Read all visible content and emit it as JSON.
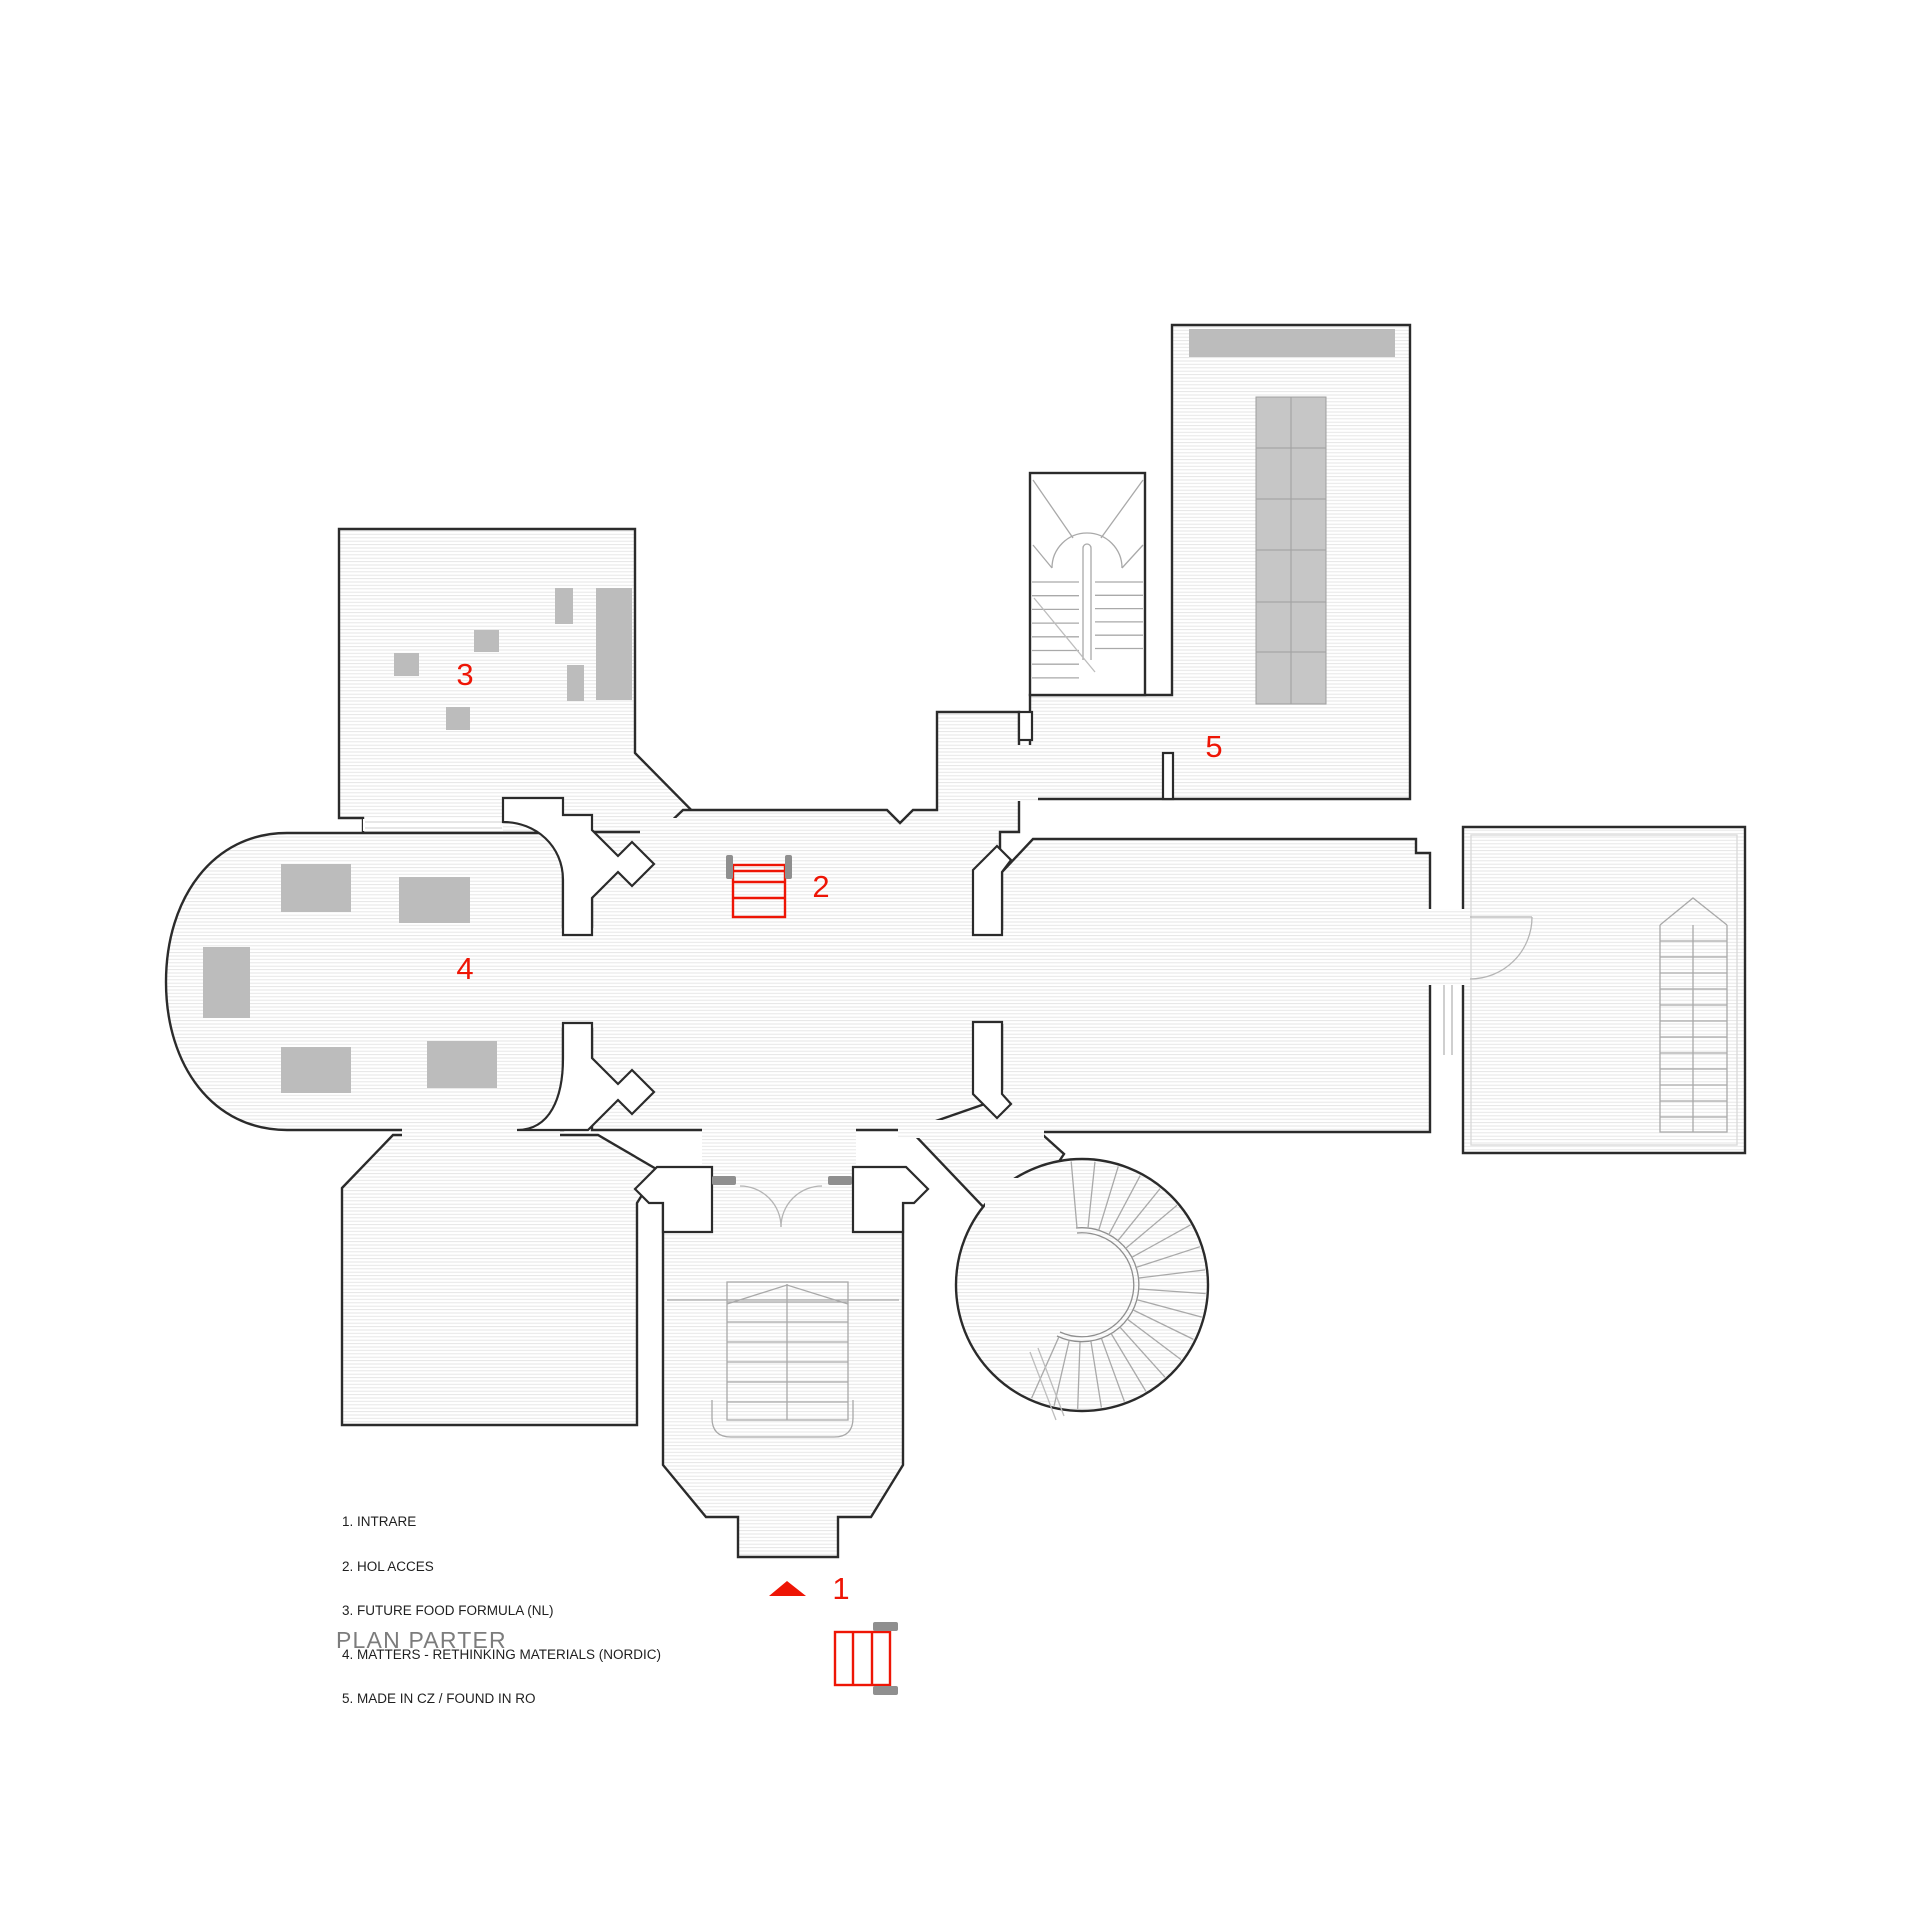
{
  "title": "PLAN PARTER",
  "legend": {
    "items": [
      "1. INTRARE",
      "2. HOL ACCES",
      "3. FUTURE FOOD FORMULA (NL)",
      "4. MATTERS - RETHINKING MATERIALS (NORDIC)",
      "5. MADE IN CZ / FOUND IN RO"
    ]
  },
  "labels": {
    "n1": "1",
    "n2": "2",
    "n3": "3",
    "n4": "4",
    "n5": "5"
  },
  "colors": {
    "accent_red": "#ee1505",
    "wall_outline": "#2b2b2b",
    "furniture_grey": "#bcbcbc",
    "tile_grey": "#c6c6c6",
    "stair_grey": "#a9a9a9",
    "hatch_grey": "#e4e4e4",
    "jamb_grey": "#8f8f8f",
    "title_grey": "#7c7c7c"
  },
  "icons": {
    "entrance_arrow": "entrance-direction-triangle",
    "access_steps": "red-access-steps",
    "entrance_gate": "red-entrance-gate"
  }
}
